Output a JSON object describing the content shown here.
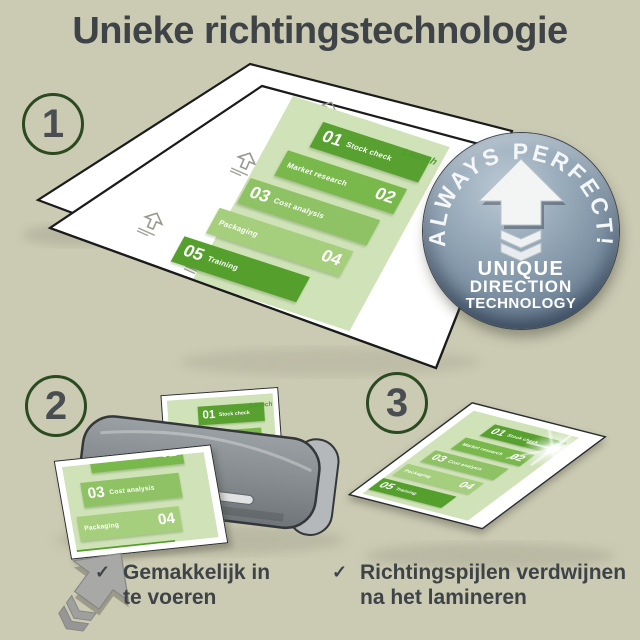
{
  "title": "Unieke richtingstechnologie",
  "steps": [
    {
      "number": "1"
    },
    {
      "number": "2"
    },
    {
      "number": "3"
    }
  ],
  "badge": {
    "arc_text": "ALWAYS PERFECT!",
    "line1": "UNIQUE",
    "line2": "DIRECTION",
    "line3": "TECHNOLOGY"
  },
  "infographic": {
    "launch_label": "Launch",
    "items": [
      {
        "num": "01",
        "label": "Stock check",
        "color": "#58a02f",
        "num_side": "left"
      },
      {
        "num": "02",
        "label": "Market research",
        "color": "#79b94c",
        "num_side": "right"
      },
      {
        "num": "03",
        "label": "Cost analysis",
        "color": "#8ec264",
        "num_side": "left"
      },
      {
        "num": "04",
        "label": "Packaging",
        "color": "#a5cf7c",
        "num_side": "right"
      },
      {
        "num": "05",
        "label": "Training",
        "color": "#55a02c",
        "num_side": "left"
      }
    ]
  },
  "captions": [
    {
      "icon": "✓",
      "line1": "Gemakkelijk in",
      "line2": "te voeren"
    },
    {
      "icon": "✓",
      "line1": "Richtingspijlen verdwijnen",
      "line2": "na het lamineren"
    }
  ],
  "colors": {
    "background": "#cbcab3",
    "title_text": "#3e4347",
    "step_circle_ring": "#2c4a21",
    "badge_base": "#7e93a5",
    "doc_background": "#cfe2b8",
    "launch_green": "#4f9c2e",
    "machine_gray": "#8b8f93",
    "feed_arrow_gray": "#a8a9a6",
    "pouch_outline": "#1b1b1b"
  }
}
